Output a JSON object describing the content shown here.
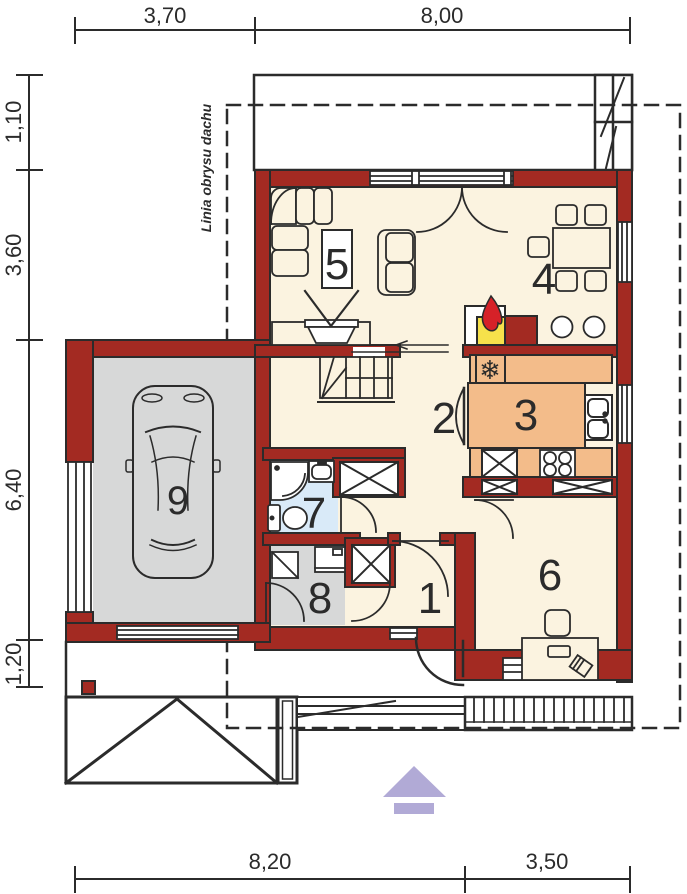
{
  "drawing": {
    "type": "floor-plan",
    "roof_outline_label": "Linia obrysu dachu"
  },
  "dimensions": {
    "top": [
      "3,70",
      "8,00"
    ],
    "left": [
      "1,10",
      "3,60",
      "6,40",
      "1,20"
    ],
    "bottom": [
      "8,20",
      "3,50"
    ]
  },
  "room_labels": [
    "1",
    "2",
    "3",
    "4",
    "5",
    "6",
    "7",
    "8",
    "9"
  ],
  "icons": {
    "fridge": {
      "name": "snowflake-icon",
      "glyph": "❄"
    },
    "fireplace": {
      "name": "flame-icon"
    },
    "north": {
      "name": "north-arrow-icon"
    }
  },
  "colors": {
    "wall": "#A32A22",
    "floor": "#FBF3E0",
    "kitchen_counter": "#F3BC8A",
    "bathroom_floor": "#D9EAF8",
    "garage_floor": "#D7D8D8",
    "fireplace_yellow": "#F6E14B",
    "flame_red": "#D62128",
    "north_arrow_purple": "#B1AAD6",
    "line": "#2B2B2B"
  }
}
